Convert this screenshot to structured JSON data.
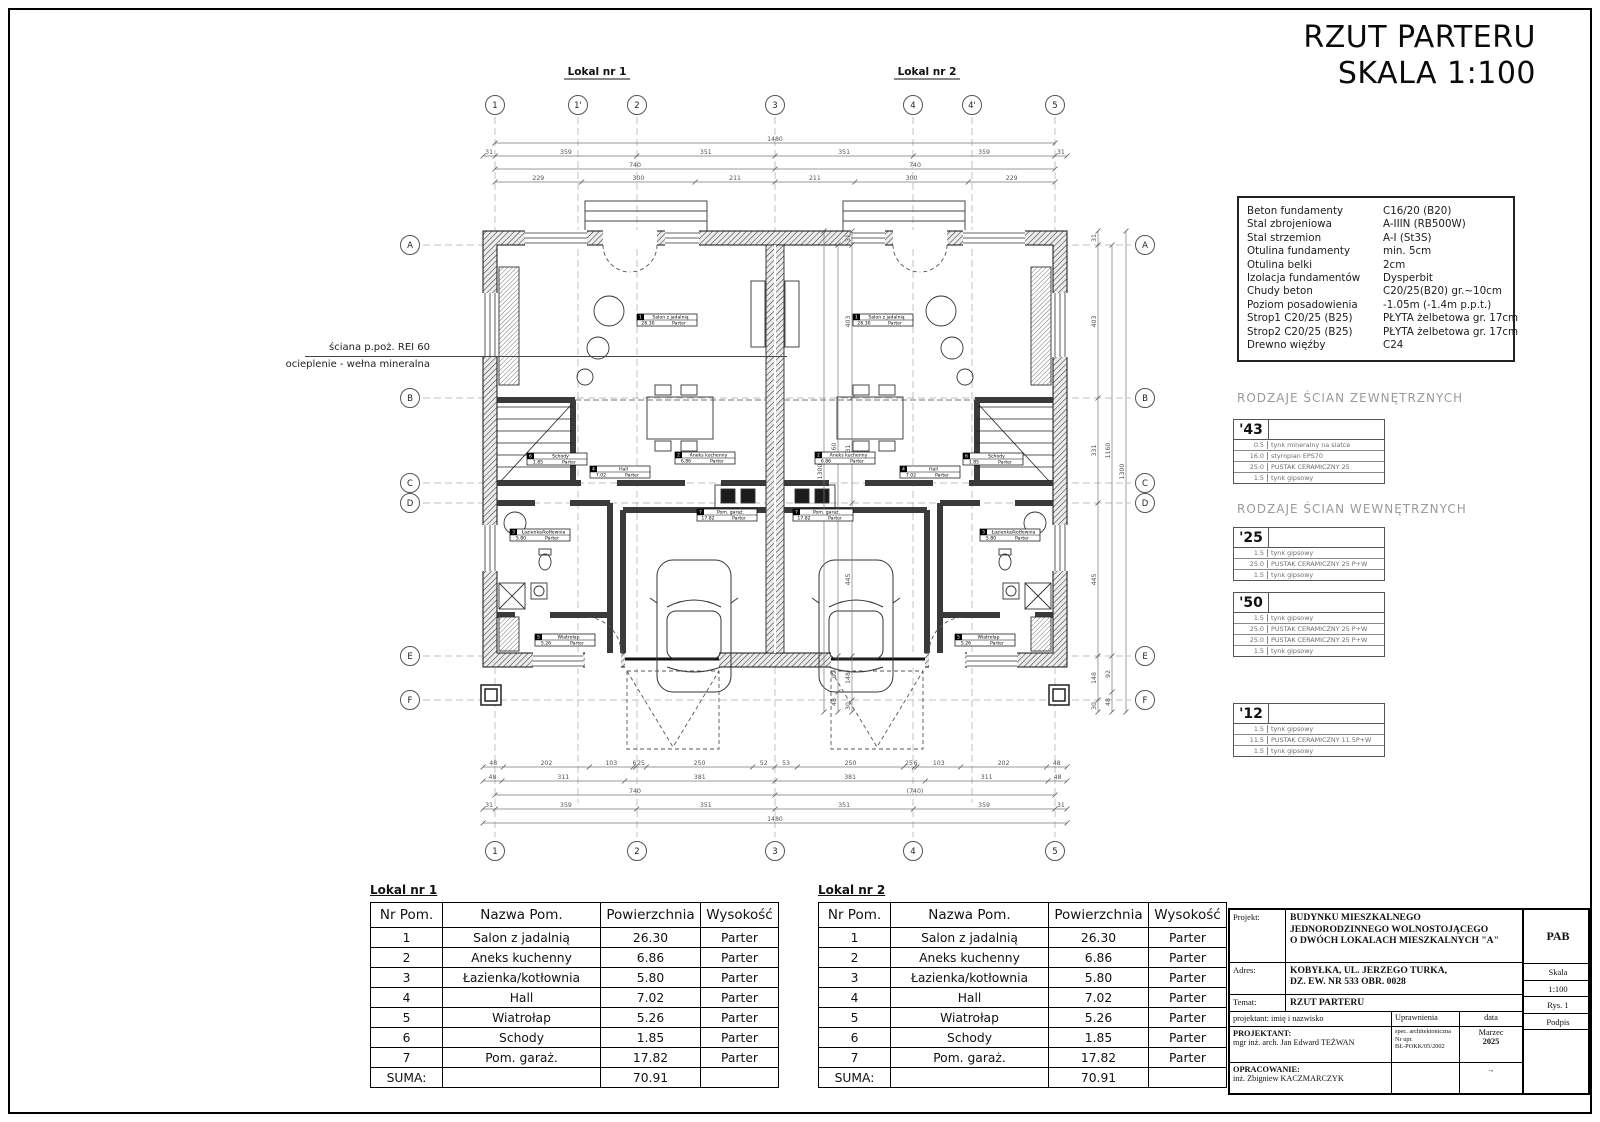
{
  "title": {
    "line1": "RZUT PARTERU",
    "line2": "SKALA 1:100"
  },
  "plan": {
    "unit1_label": "Lokal nr 1",
    "unit2_label": "Lokal nr 2",
    "note_line1": "ściana p.poż. REI 60",
    "note_line2": "ocieplenie - wełna mineralna",
    "grid": {
      "top": [
        "1",
        "1'",
        "2",
        "3",
        "4",
        "4'",
        "5"
      ],
      "bottom": [
        "1",
        "2",
        "3",
        "4",
        "5"
      ],
      "rows": [
        "A",
        "B",
        "C",
        "D",
        "E",
        "F"
      ]
    },
    "dims": {
      "top_rows": [
        [
          "1480"
        ],
        [
          "31",
          "359",
          "351",
          "351",
          "359",
          "31"
        ],
        [
          "740",
          "740"
        ],
        [
          "229",
          "300",
          "211",
          "211",
          "300",
          "229"
        ]
      ],
      "bottom_rows": [
        [
          "48",
          "202",
          "103",
          "6",
          "25",
          "250",
          "52",
          "53",
          "250",
          "25",
          "6",
          "103",
          "202",
          "48"
        ],
        [
          "48",
          "311",
          "381",
          "381",
          "311",
          "48"
        ],
        [
          "740",
          "(740)"
        ],
        [
          "31",
          "359",
          "351",
          "351",
          "359",
          "31"
        ],
        [
          "1480"
        ]
      ],
      "left_cols": [
        [
          "31",
          "403",
          "331",
          "445",
          "148",
          "30"
        ],
        [
          "1160",
          "92",
          "48"
        ],
        [
          "1300"
        ]
      ],
      "right_cols": [
        [
          "31",
          "403",
          "331",
          "445",
          "148",
          "30"
        ],
        [
          "1160",
          "92",
          "48"
        ],
        [
          "1300"
        ]
      ]
    }
  },
  "rooms": [
    {
      "num": "1",
      "name": "Salon z jadalnią",
      "area": "26.30",
      "level": "Parter"
    },
    {
      "num": "2",
      "name": "Aneks kuchenny",
      "area": "6.86",
      "level": "Parter"
    },
    {
      "num": "3",
      "name": "Łazienka/kotłownia",
      "area": "5.80",
      "level": "Parter"
    },
    {
      "num": "4",
      "name": "Hall",
      "area": "7.02",
      "level": "Parter"
    },
    {
      "num": "5",
      "name": "Wiatrołap",
      "area": "5.26",
      "level": "Parter"
    },
    {
      "num": "6",
      "name": "Schody",
      "area": "1.85",
      "level": "Parter"
    },
    {
      "num": "7",
      "name": "Pom. garaż.",
      "area": "17.82",
      "level": "Parter"
    }
  ],
  "spec_box": {
    "rows": [
      {
        "label": "Beton fundamenty",
        "value": "C16/20 (B20)"
      },
      {
        "label": "Stal zbrojeniowa",
        "value": "A-IIIN (RB500W)"
      },
      {
        "label": "Stal strzemion",
        "value": "A-I (St3S)"
      },
      {
        "label": "Otulina fundamenty",
        "value": "min. 5cm"
      },
      {
        "label": "Otulina belki",
        "value": "2cm"
      },
      {
        "label": "Izolacja fundamentów",
        "value": "Dysperbit"
      },
      {
        "label": "Chudy beton",
        "value": "C20/25(B20) gr.~10cm"
      },
      {
        "label": "Poziom posadowienia",
        "value": "-1.05m (-1.4m p.p.t.)"
      },
      {
        "label": "Strop1 C20/25 (B25)",
        "value": "PŁYTA żelbetowa gr. 17cm"
      },
      {
        "label": "Strop2 C20/25 (B25)",
        "value": "PŁYTA żelbetowa gr. 17cm"
      },
      {
        "label": "Drewno więźby",
        "value": "C24"
      }
    ]
  },
  "wall_types": {
    "external_heading": "RODZAJE ŚCIAN ZEWNĘTRZNYCH",
    "internal_heading": "RODZAJE ŚCIAN WEWNĘTRZNYCH",
    "types": [
      {
        "code": "'43",
        "layers": [
          [
            "0.5",
            "tynk mineralny na siatce"
          ],
          [
            "16.0",
            "styropian EPS70"
          ],
          [
            "25.0",
            "PUSTAK CERAMICZNY 25"
          ],
          [
            "1.5",
            "tynk gipsowy"
          ]
        ]
      },
      {
        "code": "'25",
        "layers": [
          [
            "1.5",
            "tynk gipsowy"
          ],
          [
            "25.0",
            "PUSTAK CERAMICZNY 25 P+W"
          ],
          [
            "1.5",
            "tynk gipsowy"
          ]
        ]
      },
      {
        "code": "'50",
        "layers": [
          [
            "1.5",
            "tynk gipsowy"
          ],
          [
            "25.0",
            "PUSTAK CERAMICZNY 25 P+W"
          ],
          [
            "25.0",
            "PUSTAK CERAMICZNY 25 P+W"
          ],
          [
            "1.5",
            "tynk gipsowy"
          ]
        ]
      },
      {
        "code": "'12",
        "layers": [
          [
            "1.5",
            "tynk gipsowy"
          ],
          [
            "11.5",
            "PUSTAK CERAMICZNY 11.5P+W"
          ],
          [
            "1.5",
            "tynk gipsowy"
          ]
        ]
      }
    ]
  },
  "room_tables": {
    "headers": [
      "Nr Pom.",
      "Nazwa Pom.",
      "Powierzchnia",
      "Wysokość"
    ],
    "lokal1_label": "Lokal nr 1",
    "lokal2_label": "Lokal nr 2",
    "sum_label": "SUMA:",
    "sum_value": "70.91"
  },
  "title_block": {
    "projekt_label": "Projekt:",
    "projekt_value_lines": [
      "BUDYNKU MIESZKALNEGO",
      "JEDNORODZINNEGO WOLNOSTOJĄCEGO",
      "O DWÓCH LOKALACH MIESZKALNYCH \"A\""
    ],
    "adres_label": "Adres:",
    "adres_value_lines": [
      "KOBYŁKA, UL. JERZEGO TURKA,",
      "DZ. EW. NR 533 OBR. 0028"
    ],
    "temat_label": "Temat:",
    "temat_value": "RZUT PARTERU",
    "header_name": "projektant: imię i nazwisko",
    "header_upr": "Uprawnienia",
    "header_data": "data",
    "header_podpis": "Podpis",
    "projektant_label": "PROJEKTANT:",
    "projektant_name": "mgr inż. arch. Jan Edward TEŻWAN",
    "projektant_upr_lines": [
      "spec. architektoniczna",
      "Nr upr.",
      "BŁ-POKK/05/2002"
    ],
    "projektant_date_lines": [
      "Marzec",
      "2025"
    ],
    "opracowanie_label": "OPRACOWANIE:",
    "opracowanie_name": "inż. Zbigniew KACZMARCZYK",
    "opracowanie_date_mark": ".,",
    "code": "PAB",
    "skala_label": "Skala",
    "skala_value": "1:100",
    "rys": "Rys. 1"
  }
}
